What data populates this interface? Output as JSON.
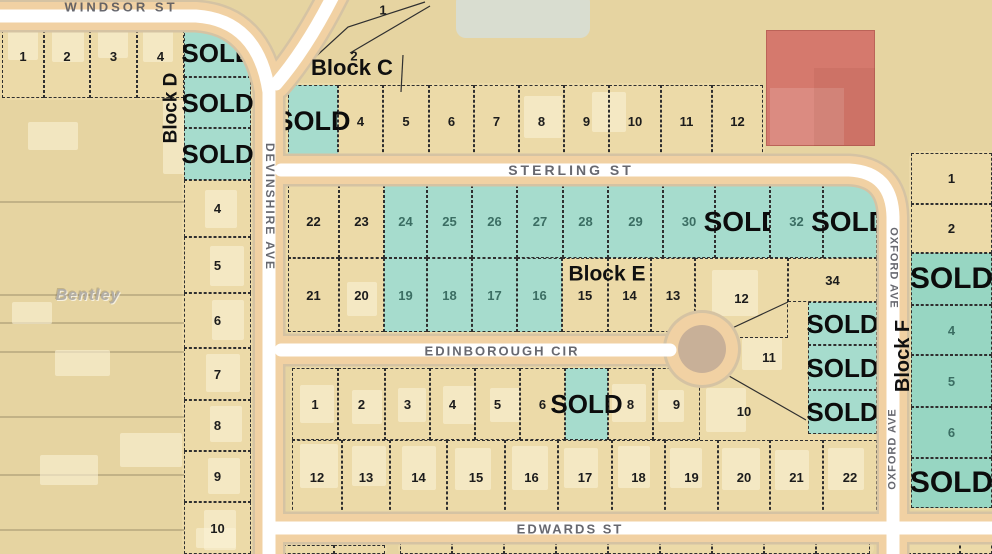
{
  "sold_text": "SOLD",
  "watermark_text": "Bentley",
  "colors": {
    "teal_sold": "#a6dccd",
    "teal_sold_dark": "#97d6c2",
    "road_casing": "#f1d1a3",
    "road_center": "#ffffff",
    "building_red": "#d5796d",
    "ground_tan": "#e6d4a1"
  },
  "street_labels": [
    {
      "text": "WINDSOR ST",
      "x": 121,
      "y": 7,
      "rot": 0,
      "size": 13,
      "ls": 3
    },
    {
      "text": "DEVINSHIRE AVE",
      "x": 270,
      "y": 207,
      "rot": 90,
      "size": 12,
      "ls": 2
    },
    {
      "text": "STERLING ST",
      "x": 571,
      "y": 170,
      "rot": 0,
      "size": 14,
      "ls": 3
    },
    {
      "text": "EDINBOROUGH CIR",
      "x": 502,
      "y": 351,
      "rot": 0,
      "size": 13,
      "ls": 2
    },
    {
      "text": "EDWARDS ST",
      "x": 570,
      "y": 529,
      "rot": 0,
      "size": 13,
      "ls": 2
    },
    {
      "text": "OXFORD AVE",
      "x": 893,
      "y": 268,
      "rot": 90,
      "size": 11,
      "ls": 1
    },
    {
      "text": "OXFORD AVE",
      "x": 893,
      "y": 449,
      "rot": -90,
      "size": 11,
      "ls": 1
    }
  ],
  "block_labels": [
    {
      "text": "Block D",
      "x": 171,
      "y": 108,
      "rot": -90,
      "size": 19
    },
    {
      "text": "Block C",
      "x": 352,
      "y": 68,
      "rot": 0,
      "size": 22
    },
    {
      "text": "Block E",
      "x": 607,
      "y": 274,
      "rot": 0,
      "size": 21
    },
    {
      "text": "Block F",
      "x": 903,
      "y": 356,
      "rot": -90,
      "size": 20
    }
  ],
  "free_numbers": [
    {
      "text": "1",
      "x": 383,
      "y": 10
    },
    {
      "text": "2",
      "x": 354,
      "y": 56
    }
  ],
  "watermark": {
    "x": 88,
    "y": 296,
    "size": 16
  },
  "platforms": [
    {
      "x": 0,
      "y": 13,
      "w": 186,
      "h": 87
    },
    {
      "x": 182,
      "y": 22,
      "w": 71,
      "h": 532
    },
    {
      "x": 286,
      "y": 83,
      "w": 479,
      "h": 76
    },
    {
      "x": 286,
      "y": 183,
      "w": 593,
      "h": 151
    },
    {
      "x": 695,
      "y": 183,
      "w": 184,
      "h": 253
    },
    {
      "x": 290,
      "y": 366,
      "w": 589,
      "h": 151
    },
    {
      "x": 909,
      "y": 151,
      "w": 85,
      "h": 359
    },
    {
      "x": 281,
      "y": 543,
      "w": 106,
      "h": 13
    },
    {
      "x": 398,
      "y": 540,
      "w": 476,
      "h": 16
    },
    {
      "x": 906,
      "y": 538,
      "w": 88,
      "h": 18
    }
  ],
  "red_building": {
    "x": 766,
    "y": 30,
    "w": 109,
    "h": 116
  },
  "buildings": [
    {
      "x": 8,
      "y": 20,
      "w": 30,
      "h": 40
    },
    {
      "x": 52,
      "y": 16,
      "w": 32,
      "h": 46
    },
    {
      "x": 98,
      "y": 16,
      "w": 30,
      "h": 42
    },
    {
      "x": 143,
      "y": 16,
      "w": 30,
      "h": 46
    },
    {
      "x": 163,
      "y": 100,
      "w": 52,
      "h": 74
    },
    {
      "x": 28,
      "y": 122,
      "w": 50,
      "h": 28
    },
    {
      "x": 12,
      "y": 302,
      "w": 40,
      "h": 22
    },
    {
      "x": 55,
      "y": 350,
      "w": 55,
      "h": 26
    },
    {
      "x": 120,
      "y": 433,
      "w": 62,
      "h": 34
    },
    {
      "x": 40,
      "y": 455,
      "w": 58,
      "h": 30
    },
    {
      "x": 196,
      "y": 528,
      "w": 40,
      "h": 20
    },
    {
      "x": 205,
      "y": 190,
      "w": 32,
      "h": 38
    },
    {
      "x": 210,
      "y": 246,
      "w": 34,
      "h": 40
    },
    {
      "x": 212,
      "y": 300,
      "w": 32,
      "h": 40
    },
    {
      "x": 206,
      "y": 354,
      "w": 34,
      "h": 38
    },
    {
      "x": 210,
      "y": 406,
      "w": 32,
      "h": 36
    },
    {
      "x": 208,
      "y": 458,
      "w": 32,
      "h": 36
    },
    {
      "x": 204,
      "y": 510,
      "w": 32,
      "h": 40
    },
    {
      "x": 524,
      "y": 96,
      "w": 38,
      "h": 42
    },
    {
      "x": 592,
      "y": 92,
      "w": 34,
      "h": 40
    },
    {
      "x": 347,
      "y": 282,
      "w": 30,
      "h": 34
    },
    {
      "x": 712,
      "y": 270,
      "w": 46,
      "h": 46
    },
    {
      "x": 742,
      "y": 338,
      "w": 40,
      "h": 32
    },
    {
      "x": 300,
      "y": 385,
      "w": 34,
      "h": 38
    },
    {
      "x": 352,
      "y": 390,
      "w": 30,
      "h": 34
    },
    {
      "x": 398,
      "y": 388,
      "w": 28,
      "h": 34
    },
    {
      "x": 443,
      "y": 386,
      "w": 32,
      "h": 38
    },
    {
      "x": 490,
      "y": 388,
      "w": 30,
      "h": 34
    },
    {
      "x": 612,
      "y": 384,
      "w": 34,
      "h": 38
    },
    {
      "x": 658,
      "y": 390,
      "w": 26,
      "h": 32
    },
    {
      "x": 706,
      "y": 388,
      "w": 40,
      "h": 44
    },
    {
      "x": 300,
      "y": 444,
      "w": 38,
      "h": 44
    },
    {
      "x": 352,
      "y": 446,
      "w": 34,
      "h": 40
    },
    {
      "x": 402,
      "y": 446,
      "w": 34,
      "h": 44
    },
    {
      "x": 455,
      "y": 448,
      "w": 36,
      "h": 42
    },
    {
      "x": 512,
      "y": 446,
      "w": 36,
      "h": 44
    },
    {
      "x": 564,
      "y": 448,
      "w": 34,
      "h": 40
    },
    {
      "x": 618,
      "y": 446,
      "w": 32,
      "h": 42
    },
    {
      "x": 670,
      "y": 448,
      "w": 32,
      "h": 40
    },
    {
      "x": 722,
      "y": 448,
      "w": 38,
      "h": 42
    },
    {
      "x": 775,
      "y": 450,
      "w": 34,
      "h": 40
    },
    {
      "x": 828,
      "y": 448,
      "w": 36,
      "h": 42
    }
  ],
  "lots": [
    {
      "n": "1",
      "x": 2,
      "y": 15,
      "w": 42,
      "h": 83
    },
    {
      "n": "2",
      "x": 44,
      "y": 15,
      "w": 46,
      "h": 83
    },
    {
      "n": "3",
      "x": 90,
      "y": 15,
      "w": 47,
      "h": 83
    },
    {
      "n": "4",
      "x": 137,
      "y": 15,
      "w": 47,
      "h": 83
    },
    {
      "sold": true,
      "fs": 26,
      "f": "g",
      "x": 184,
      "y": 28,
      "w": 67,
      "h": 49
    },
    {
      "sold": true,
      "fs": 26,
      "f": "g",
      "x": 184,
      "y": 77,
      "w": 67,
      "h": 51
    },
    {
      "sold": true,
      "fs": 26,
      "f": "g",
      "x": 184,
      "y": 128,
      "w": 67,
      "h": 52
    },
    {
      "n": "4",
      "x": 184,
      "y": 180,
      "w": 67,
      "h": 57
    },
    {
      "n": "5",
      "x": 184,
      "y": 237,
      "w": 67,
      "h": 56
    },
    {
      "n": "6",
      "x": 184,
      "y": 293,
      "w": 67,
      "h": 55
    },
    {
      "n": "7",
      "x": 184,
      "y": 348,
      "w": 67,
      "h": 52
    },
    {
      "n": "8",
      "x": 184,
      "y": 400,
      "w": 67,
      "h": 51
    },
    {
      "n": "9",
      "x": 184,
      "y": 451,
      "w": 67,
      "h": 51
    },
    {
      "n": "10",
      "x": 184,
      "y": 502,
      "w": 67,
      "h": 52
    },
    {
      "sold": true,
      "fs": 27,
      "f": "g",
      "x": 288,
      "y": 85,
      "w": 50,
      "h": 72
    },
    {
      "n": "4",
      "x": 338,
      "y": 85,
      "w": 45,
      "h": 72
    },
    {
      "n": "5",
      "x": 383,
      "y": 85,
      "w": 46,
      "h": 72
    },
    {
      "n": "6",
      "x": 429,
      "y": 85,
      "w": 45,
      "h": 72
    },
    {
      "n": "7",
      "x": 474,
      "y": 85,
      "w": 45,
      "h": 72
    },
    {
      "n": "8",
      "x": 519,
      "y": 85,
      "w": 45,
      "h": 72
    },
    {
      "n": "9",
      "x": 564,
      "y": 85,
      "w": 45,
      "h": 72
    },
    {
      "n": "10",
      "x": 609,
      "y": 85,
      "w": 52,
      "h": 72
    },
    {
      "n": "11",
      "x": 661,
      "y": 85,
      "w": 51,
      "h": 72
    },
    {
      "n": "12",
      "x": 712,
      "y": 85,
      "w": 51,
      "h": 72
    },
    {
      "n": "22",
      "x": 288,
      "y": 185,
      "w": 51,
      "h": 73
    },
    {
      "n": "23",
      "x": 339,
      "y": 185,
      "w": 45,
      "h": 73
    },
    {
      "n": "24",
      "f": "g",
      "x": 384,
      "y": 185,
      "w": 43,
      "h": 73
    },
    {
      "n": "25",
      "f": "g",
      "x": 427,
      "y": 185,
      "w": 45,
      "h": 73
    },
    {
      "n": "26",
      "f": "g",
      "x": 472,
      "y": 185,
      "w": 45,
      "h": 73
    },
    {
      "n": "27",
      "f": "g",
      "x": 517,
      "y": 185,
      "w": 46,
      "h": 73
    },
    {
      "n": "28",
      "f": "g",
      "x": 563,
      "y": 185,
      "w": 45,
      "h": 73
    },
    {
      "n": "29",
      "f": "g",
      "x": 608,
      "y": 185,
      "w": 55,
      "h": 73
    },
    {
      "n": "30",
      "f": "g",
      "x": 663,
      "y": 185,
      "w": 52,
      "h": 73
    },
    {
      "sold": true,
      "fs": 28,
      "f": "g",
      "x": 715,
      "y": 185,
      "w": 55,
      "h": 73
    },
    {
      "n": "32",
      "f": "g",
      "x": 770,
      "y": 185,
      "w": 53,
      "h": 73
    },
    {
      "sold": true,
      "fs": 28,
      "f": "g",
      "x": 823,
      "y": 185,
      "w": 54,
      "h": 73
    },
    {
      "n": "21",
      "x": 288,
      "y": 258,
      "w": 51,
      "h": 74
    },
    {
      "n": "20",
      "x": 339,
      "y": 258,
      "w": 45,
      "h": 74
    },
    {
      "n": "19",
      "f": "g",
      "x": 384,
      "y": 258,
      "w": 43,
      "h": 74
    },
    {
      "n": "18",
      "f": "g",
      "x": 427,
      "y": 258,
      "w": 45,
      "h": 74
    },
    {
      "n": "17",
      "f": "g",
      "x": 472,
      "y": 258,
      "w": 45,
      "h": 74
    },
    {
      "n": "16",
      "f": "g",
      "x": 517,
      "y": 258,
      "w": 45,
      "h": 74
    },
    {
      "n": "15",
      "x": 562,
      "y": 258,
      "w": 46,
      "h": 74
    },
    {
      "n": "14",
      "x": 608,
      "y": 258,
      "w": 43,
      "h": 74
    },
    {
      "n": "13",
      "x": 651,
      "y": 258,
      "w": 44,
      "h": 74
    },
    {
      "n": "12",
      "x": 695,
      "y": 258,
      "w": 93,
      "h": 80
    },
    {
      "n": "34",
      "x": 788,
      "y": 258,
      "w": 89,
      "h": 44
    },
    {
      "sold": true,
      "fs": 26,
      "f": "g",
      "x": 808,
      "y": 302,
      "w": 69,
      "h": 43
    },
    {
      "sold": true,
      "fs": 26,
      "f": "g",
      "x": 808,
      "y": 345,
      "w": 69,
      "h": 45
    },
    {
      "sold": true,
      "fs": 26,
      "f": "g",
      "x": 808,
      "y": 390,
      "w": 69,
      "h": 44
    },
    {
      "n": "1",
      "x": 292,
      "y": 368,
      "w": 46,
      "h": 72
    },
    {
      "n": "2",
      "x": 338,
      "y": 368,
      "w": 47,
      "h": 72
    },
    {
      "n": "3",
      "x": 385,
      "y": 368,
      "w": 45,
      "h": 72
    },
    {
      "n": "4",
      "x": 430,
      "y": 368,
      "w": 45,
      "h": 72
    },
    {
      "n": "5",
      "x": 475,
      "y": 368,
      "w": 45,
      "h": 72
    },
    {
      "n": "6",
      "x": 520,
      "y": 368,
      "w": 45,
      "h": 72
    },
    {
      "sold": true,
      "fs": 26,
      "f": "g",
      "x": 565,
      "y": 368,
      "w": 43,
      "h": 72
    },
    {
      "n": "8",
      "x": 608,
      "y": 368,
      "w": 45,
      "h": 72
    },
    {
      "n": "9",
      "x": 653,
      "y": 368,
      "w": 47,
      "h": 72
    },
    {
      "n": "10",
      "nb": true,
      "x": 700,
      "y": 375,
      "w": 88,
      "h": 72
    },
    {
      "n": "11",
      "nb": true,
      "x": 724,
      "y": 327,
      "w": 90,
      "h": 60
    },
    {
      "n": "12",
      "x": 292,
      "y": 440,
      "w": 50,
      "h": 75
    },
    {
      "n": "13",
      "x": 342,
      "y": 440,
      "w": 48,
      "h": 75
    },
    {
      "n": "14",
      "x": 390,
      "y": 440,
      "w": 57,
      "h": 75
    },
    {
      "n": "15",
      "x": 447,
      "y": 440,
      "w": 58,
      "h": 75
    },
    {
      "n": "16",
      "x": 505,
      "y": 440,
      "w": 53,
      "h": 75
    },
    {
      "n": "17",
      "x": 558,
      "y": 440,
      "w": 54,
      "h": 75
    },
    {
      "n": "18",
      "x": 612,
      "y": 440,
      "w": 53,
      "h": 75
    },
    {
      "n": "19",
      "x": 665,
      "y": 440,
      "w": 53,
      "h": 75
    },
    {
      "n": "20",
      "x": 718,
      "y": 440,
      "w": 52,
      "h": 75
    },
    {
      "n": "21",
      "x": 770,
      "y": 440,
      "w": 53,
      "h": 75
    },
    {
      "n": "22",
      "x": 823,
      "y": 440,
      "w": 54,
      "h": 75
    },
    {
      "n": "1",
      "x": 911,
      "y": 153,
      "w": 81,
      "h": 51
    },
    {
      "n": "2",
      "x": 911,
      "y": 204,
      "w": 81,
      "h": 49
    },
    {
      "sold": true,
      "fs": 30,
      "f": "g2",
      "x": 911,
      "y": 253,
      "w": 81,
      "h": 52
    },
    {
      "n": "4",
      "f": "g2",
      "x": 911,
      "y": 305,
      "w": 81,
      "h": 50
    },
    {
      "n": "5",
      "f": "g2",
      "x": 911,
      "y": 355,
      "w": 81,
      "h": 52
    },
    {
      "n": "6",
      "f": "g2",
      "x": 911,
      "y": 407,
      "w": 81,
      "h": 51
    },
    {
      "sold": true,
      "fs": 30,
      "f": "g2",
      "x": 911,
      "y": 458,
      "w": 81,
      "h": 50
    },
    {
      "x": 283,
      "y": 545,
      "w": 51,
      "h": 9
    },
    {
      "x": 334,
      "y": 545,
      "w": 51,
      "h": 9
    },
    {
      "x": 400,
      "y": 542,
      "w": 52,
      "h": 12
    },
    {
      "x": 452,
      "y": 542,
      "w": 52,
      "h": 12
    },
    {
      "x": 504,
      "y": 542,
      "w": 52,
      "h": 12
    },
    {
      "x": 556,
      "y": 542,
      "w": 52,
      "h": 12
    },
    {
      "x": 608,
      "y": 542,
      "w": 52,
      "h": 12
    },
    {
      "x": 660,
      "y": 542,
      "w": 52,
      "h": 12
    },
    {
      "x": 712,
      "y": 542,
      "w": 52,
      "h": 12
    },
    {
      "x": 764,
      "y": 542,
      "w": 52,
      "h": 12
    },
    {
      "x": 816,
      "y": 542,
      "w": 54,
      "h": 12
    },
    {
      "x": 908,
      "y": 540,
      "w": 52,
      "h": 14
    },
    {
      "x": 960,
      "y": 540,
      "w": 32,
      "h": 14
    }
  ]
}
